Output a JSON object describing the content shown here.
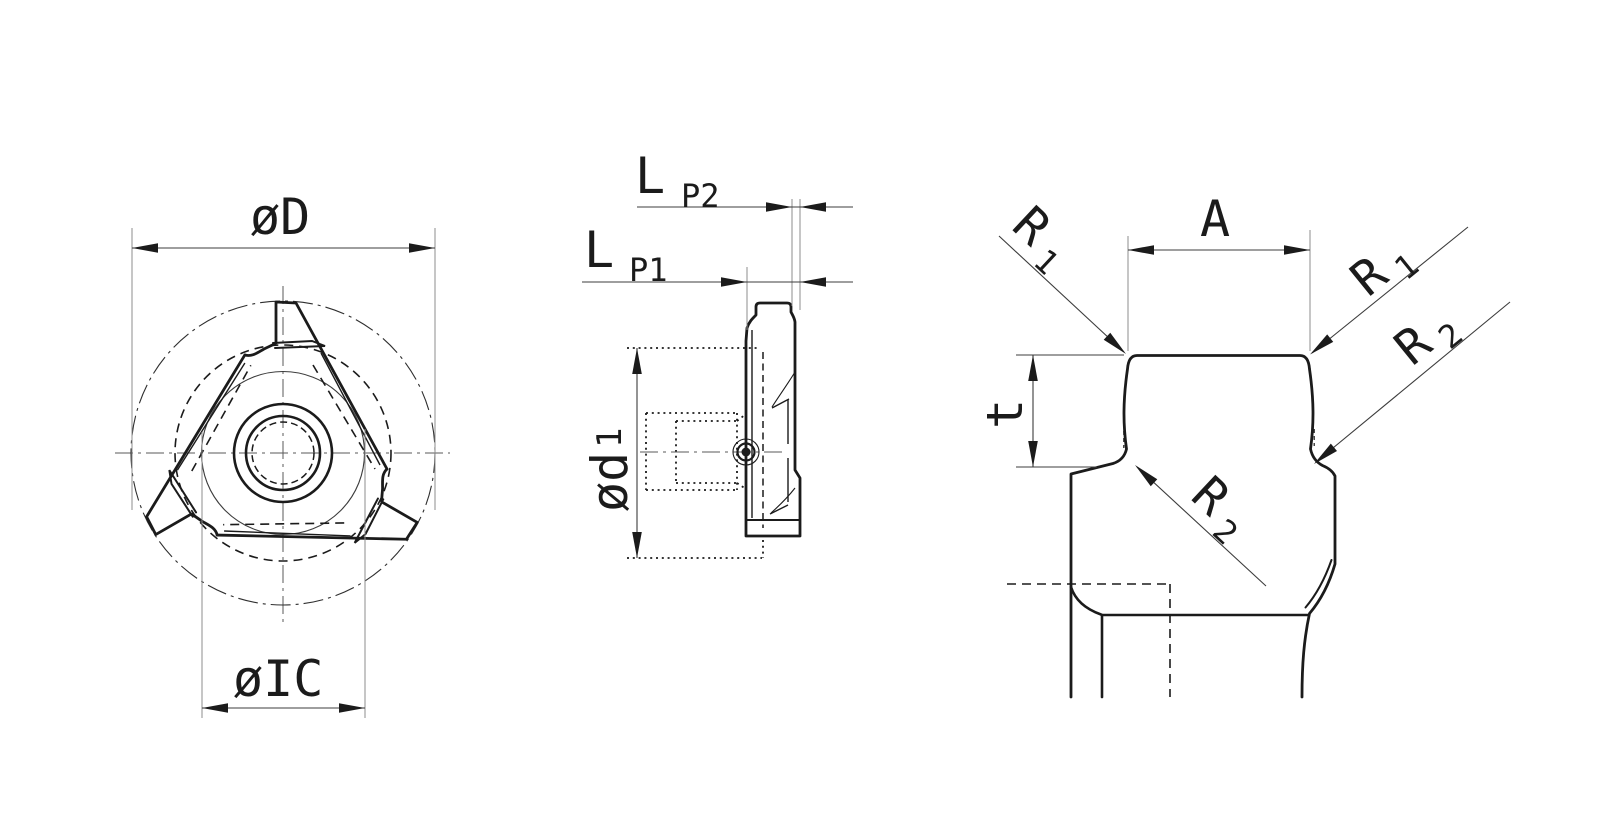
{
  "drawing": {
    "type": "technical-drawing",
    "background": "#ffffff",
    "line_color": "#1b1b1b",
    "views": {
      "top": {
        "title": "top-view",
        "labels": {
          "outer_diameter": "øD",
          "inscribed_circle": "øIC"
        }
      },
      "side": {
        "title": "side-view",
        "labels": {
          "length": "L",
          "p1_sub": "P1",
          "p2_sub": "P2",
          "bore": "ød",
          "bore_sub": "1"
        }
      },
      "detail": {
        "title": "tooth-profile-detail",
        "labels": {
          "width": "A",
          "radius": "R",
          "r1_sub": "1",
          "r2_sub": "2",
          "depth": "t"
        }
      }
    }
  }
}
